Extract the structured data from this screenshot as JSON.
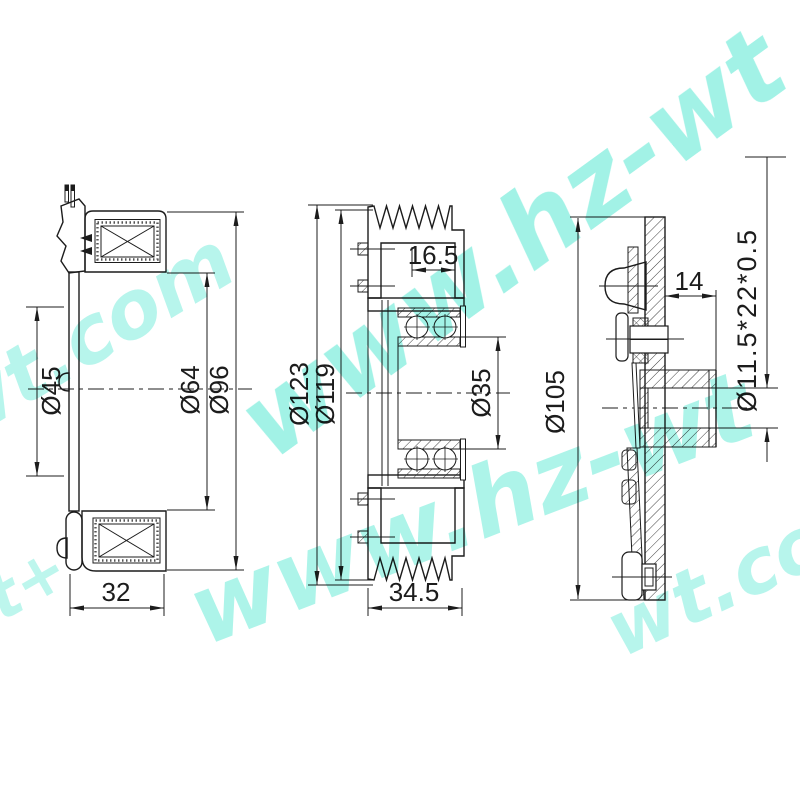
{
  "drawing": {
    "background": "#ffffff",
    "line_color": "#1c1c1c",
    "views": {
      "left": {
        "dims": {
          "d45": "Ø45",
          "d64": "Ø64",
          "d96": "Ø96",
          "w32": "32"
        }
      },
      "middle": {
        "dims": {
          "g165": "16.5",
          "d123": "Ø123",
          "d119": "Ø119",
          "d35": "Ø35",
          "w345": "34.5"
        }
      },
      "right": {
        "dims": {
          "w14": "14",
          "spec": "Ø11.5*22*0.5",
          "d105": "Ø105"
        }
      }
    },
    "watermark": {
      "color": "#7BEDDC",
      "instances": [
        {
          "text": "www.hz-wt"
        },
        {
          "text": "hz-wt.com"
        },
        {
          "text": "www.hz-wt"
        },
        {
          "text": "t+"
        },
        {
          "text": "wt.com"
        }
      ]
    }
  }
}
